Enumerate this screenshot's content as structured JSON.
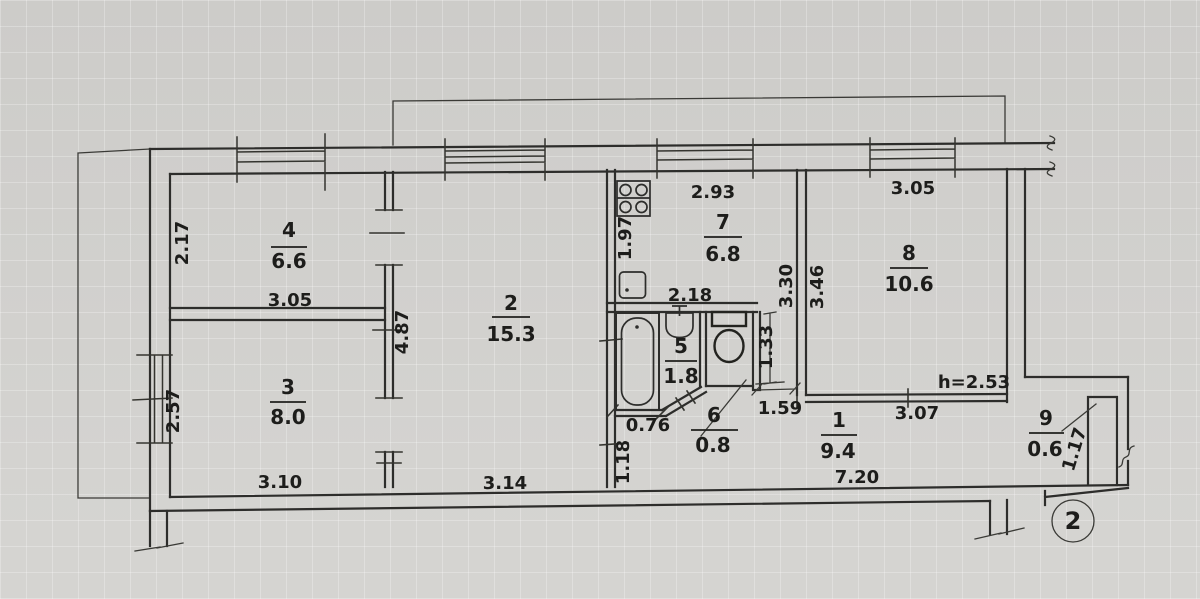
{
  "sheet": {
    "number": "2"
  },
  "rooms": {
    "r1": {
      "number": "1",
      "area": "9.4",
      "dim_top": "3.07",
      "dim_bottom": "7.20"
    },
    "r2": {
      "number": "2",
      "area": "15.3",
      "dim_bottom": "3.14",
      "dim_left": "4.87"
    },
    "r3": {
      "number": "3",
      "area": "8.0",
      "dim_bottom": "3.10",
      "dim_left": "2.57"
    },
    "r4": {
      "number": "4",
      "area": "6.6",
      "dim_bottom": "3.05",
      "dim_left": "2.17"
    },
    "r5": {
      "number": "5",
      "area": "1.8",
      "dim_bottom": "0.76",
      "dim_left": "1.18"
    },
    "r6": {
      "number": "6",
      "area": "0.8",
      "dim_right": "1.33",
      "dim_opening": "1.59"
    },
    "r7": {
      "number": "7",
      "area": "6.8",
      "dim_top": "2.93",
      "dim_left": "1.97",
      "dim_inner": "2.18"
    },
    "r8": {
      "number": "8",
      "area": "10.6",
      "dim_top": "3.05",
      "dim_left": "3.46",
      "dim_wall": "3.30",
      "ceiling": "h=2.53"
    },
    "r9": {
      "number": "9",
      "area": "0.6",
      "dim_side": "1.17"
    }
  }
}
